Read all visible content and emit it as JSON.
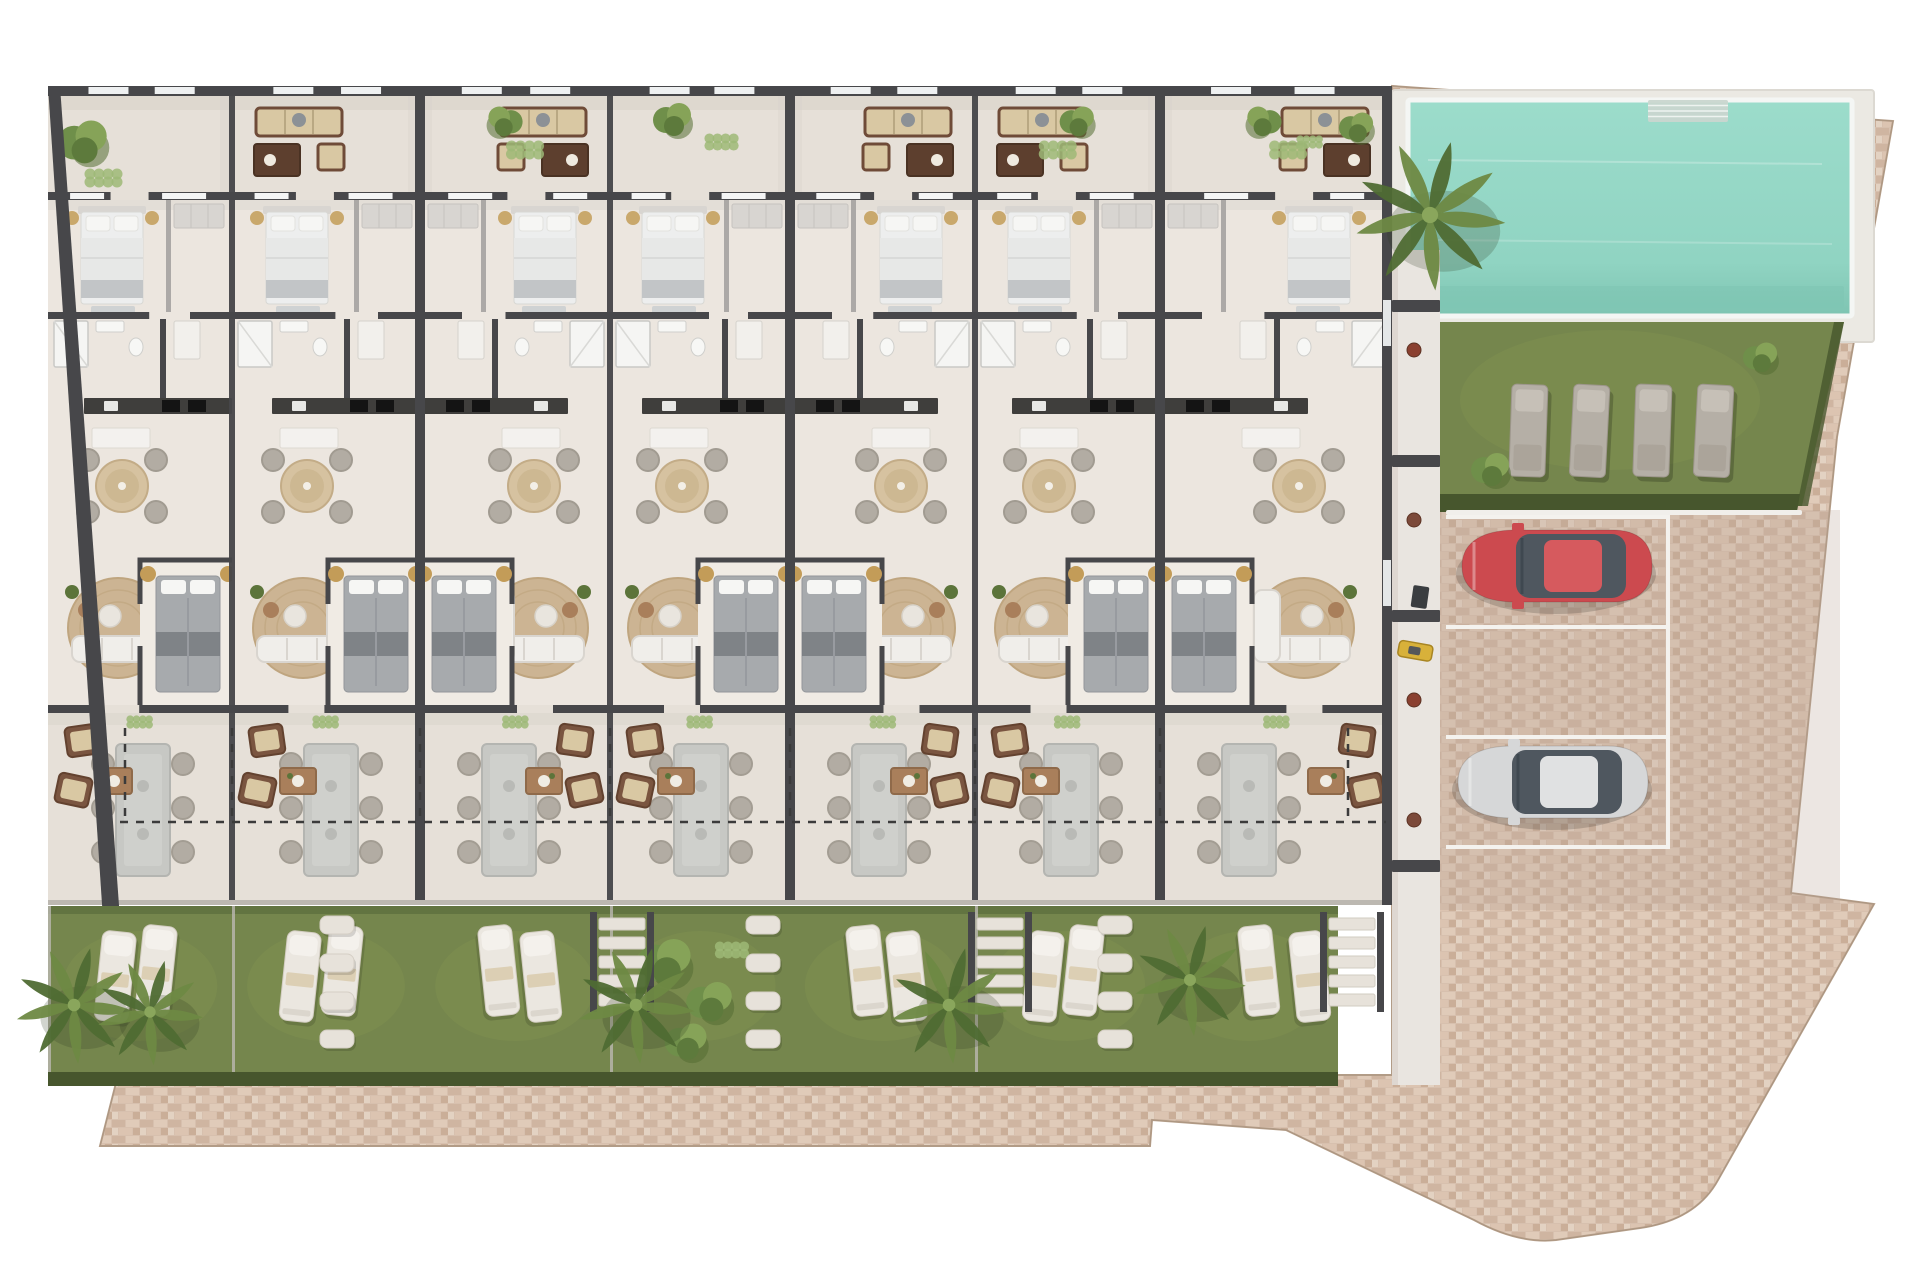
{
  "meta": {
    "type": "architectural-floor-plan",
    "view": "top-down-3d-render",
    "description": "Site plan: row of 7 terraced residential units with private gardens, communal swimming pool, sunbathing lawn and 3-space brick-paved parking; red and silver cars parked"
  },
  "canvas": {
    "width": 1920,
    "height": 1280,
    "background": "#ffffff"
  },
  "palette": {
    "wall": "#47474a",
    "wall_light": "#9c9a98",
    "floor": "#ece6df",
    "floor_light": "#f0ebe4",
    "terrace": "#e6e0d8",
    "shadow": "#d8d2ca",
    "brick": "#d7c0ae",
    "brick_gray": "#b9a696",
    "brick_edge": "#b9a28d",
    "grass": "#75864d",
    "grass_light": "#83944f",
    "hedge": "#47562d",
    "shrub": "#5c743a",
    "shrub_light": "#8aa65c",
    "pool_water": "#97d9c8",
    "pool_water_deep": "#7ec4b2",
    "pool_deck": "#ebe9e3",
    "pool_steps": "#c9d6cf",
    "kerb": "#f1efeb",
    "parking_line": "#f4f2ee",
    "rug": "#ccb493",
    "rug_ring": "#bfa57f",
    "sofa_white": "#f0eeea",
    "sofa_shadow": "#d9d5cf",
    "sofa_brown": "#6f4b38",
    "cushion_tan": "#d9c8a3",
    "wood": "#a97f5b",
    "wood_dark": "#5d3f2e",
    "bed_white": "#edeeee",
    "bed_blanket": "#c2c5c7",
    "bed_gray": "#a7aaad",
    "bed_dark": "#71767b",
    "pillow": "#f6f6f4",
    "headboard": "#d8d5d1",
    "wardrobe": "#d8d5d1",
    "chair": "#b2aca3",
    "table_gray": "#c7c8c4",
    "counter": "#3f3e3c",
    "stove": "#141414",
    "gold": "#c39c58",
    "stone": "#e7e2da",
    "fence": "#bcb8b1",
    "car_red": "#cc4a4f",
    "car_red_roof": "#d65a5e",
    "car_silver": "#d6d7d8",
    "car_silver_roof": "#e0e1e2",
    "glass": "#4f575f",
    "palm": "#4f6b33",
    "palm_light": "#6e8943",
    "scooter_yellow": "#d8b13a",
    "dash": "#3b3b3b",
    "white": "#ffffff"
  },
  "site": {
    "pool": {
      "label": "swimming-pool",
      "x": 1408,
      "y": 100,
      "w": 444,
      "h": 216,
      "steps_x": 1648,
      "steps_w": 80
    },
    "pool_lawn": {
      "label": "sunbathing-lawn",
      "loungers": 4,
      "lounger_xs": [
        1512,
        1574,
        1636,
        1698
      ],
      "lounger_y": 384,
      "poly": [
        [
          1432,
          322
        ],
        [
          1844,
          322
        ],
        [
          1802,
          506
        ],
        [
          1432,
          506
        ]
      ]
    },
    "parking": {
      "label": "parking-area",
      "spaces": 3,
      "line_ys": [
        515,
        625,
        735,
        845
      ],
      "line_x1": 1446,
      "line_x2": 1666,
      "cars": [
        {
          "name": "car-red",
          "color_key": "car_red",
          "roof_key": "car_red_roof",
          "x": 1452,
          "y": 524
        },
        {
          "name": "car-silver",
          "color_key": "car_silver",
          "roof_key": "car_silver_roof",
          "x": 1448,
          "y": 740
        }
      ]
    },
    "corridor": {
      "x": 1392,
      "y": 250,
      "w": 48,
      "h": 835,
      "gate_ys": [
        300,
        455,
        610,
        860
      ],
      "scooter_y": 640,
      "shelf_item_ys": [
        350,
        520,
        700,
        820
      ]
    },
    "brick_outline": "M 100,1146 L 118,1075 L 1392,1075 L 1392,86 L 1893,121 L 1837,437 L 1791,893 L 1874,904 L 1718,1180 Q 1696,1220 1640,1228 L 1556,1240 Q 1518,1244 1474,1220 L 1286,1130 L 1152,1120 L 1150,1146 Z"
  },
  "building": {
    "x": 48,
    "right": 1392,
    "top": 86,
    "rows": {
      "terrace_top": 96,
      "wall1": 192,
      "bed1": 200,
      "wall2": 312,
      "bath": 319,
      "kitchen": 398,
      "living": 414,
      "bed2": 560,
      "wall3": 705,
      "terrace2": 713,
      "fence": 900,
      "garden": 906,
      "hedge": 1072,
      "garden_end": 1086
    },
    "canopy_dash_y": 822,
    "canopy_dash_top": 728,
    "party_walls": [
      420,
      790,
      1160
    ],
    "dividers": [
      232,
      610,
      975
    ],
    "units": [
      {
        "id": "unit-1",
        "x": 48,
        "w": 184,
        "mirror": false,
        "garden": "loungers",
        "garden_palm": true,
        "terrace_sofa": false,
        "terrace_bush": "large"
      },
      {
        "id": "unit-2",
        "x": 232,
        "w": 188,
        "mirror": false,
        "garden": "loungers",
        "garden_palm": false,
        "terrace_sofa": true,
        "terrace_bush": "none"
      },
      {
        "id": "unit-3",
        "x": 420,
        "w": 190,
        "mirror": true,
        "garden": "loungers",
        "garden_palm": false,
        "terrace_sofa": true,
        "terrace_bush": "light"
      },
      {
        "id": "unit-4",
        "x": 610,
        "w": 180,
        "mirror": false,
        "garden": "shrubs",
        "garden_palm": true,
        "terrace_sofa": false,
        "terrace_bush": "double"
      },
      {
        "id": "unit-5",
        "x": 790,
        "w": 185,
        "mirror": true,
        "garden": "loungers",
        "garden_palm": true,
        "terrace_sofa": true,
        "terrace_bush": "none"
      },
      {
        "id": "unit-6",
        "x": 975,
        "w": 185,
        "mirror": false,
        "garden": "loungers",
        "garden_palm": false,
        "terrace_sofa": true,
        "terrace_bush": "light"
      },
      {
        "id": "unit-7",
        "x": 1160,
        "w": 232,
        "mirror": true,
        "garden": "loungers",
        "garden_palm": true,
        "terrace_sofa": true,
        "terrace_bush": "light",
        "corner": true
      }
    ]
  },
  "paths": {
    "stones_x": [
      337,
      763,
      1115
    ],
    "stairs_x": [
      622,
      1000,
      1352
    ]
  },
  "vegetation": {
    "pool_palm": {
      "x": 1430,
      "y": 215,
      "s": 1.35
    },
    "pool_bushes": [
      [
        1356,
        126,
        0.9
      ],
      [
        1310,
        142,
        0.7
      ]
    ],
    "lawn_bushes": [
      [
        1490,
        468,
        1.0
      ],
      [
        1760,
        356,
        0.9
      ]
    ]
  }
}
